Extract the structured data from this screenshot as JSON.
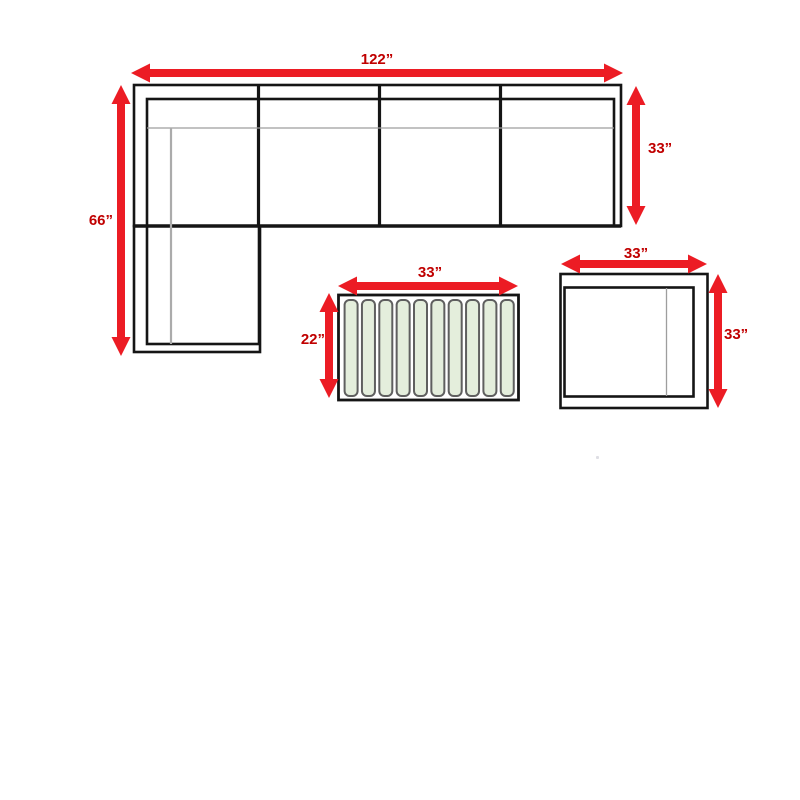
{
  "diagram": {
    "title": "sectional-set-dimension-diagram",
    "sofa": {
      "name": "l-shaped-sectional-sofa",
      "seat_sections": 4,
      "top_dim_label": "122”",
      "top_dim_value": 122,
      "left_dim_label": "66”",
      "left_dim_value": 66,
      "right_dim_label": "33”",
      "right_dim_value": 33
    },
    "coffee_table": {
      "name": "slatted-coffee-table",
      "slat_count": 10,
      "top_dim_label": "33”",
      "top_dim_value": 33,
      "side_dim_label": "22”",
      "side_dim_value": 22
    },
    "end_table": {
      "name": "square-end-table",
      "top_dim_label": "33”",
      "top_dim_value": 33,
      "side_dim_label": "33”",
      "side_dim_value": 33
    },
    "colors": {
      "arrow_red": "#EC1C24",
      "label_red": "#C00000",
      "outline_black": "#151515",
      "slat_green": "#E4EEDC",
      "slat_border_gray": "#5F5F5F",
      "seam_gray": "#9E9E9E",
      "seam_gray_light": "#ABABAB"
    }
  }
}
